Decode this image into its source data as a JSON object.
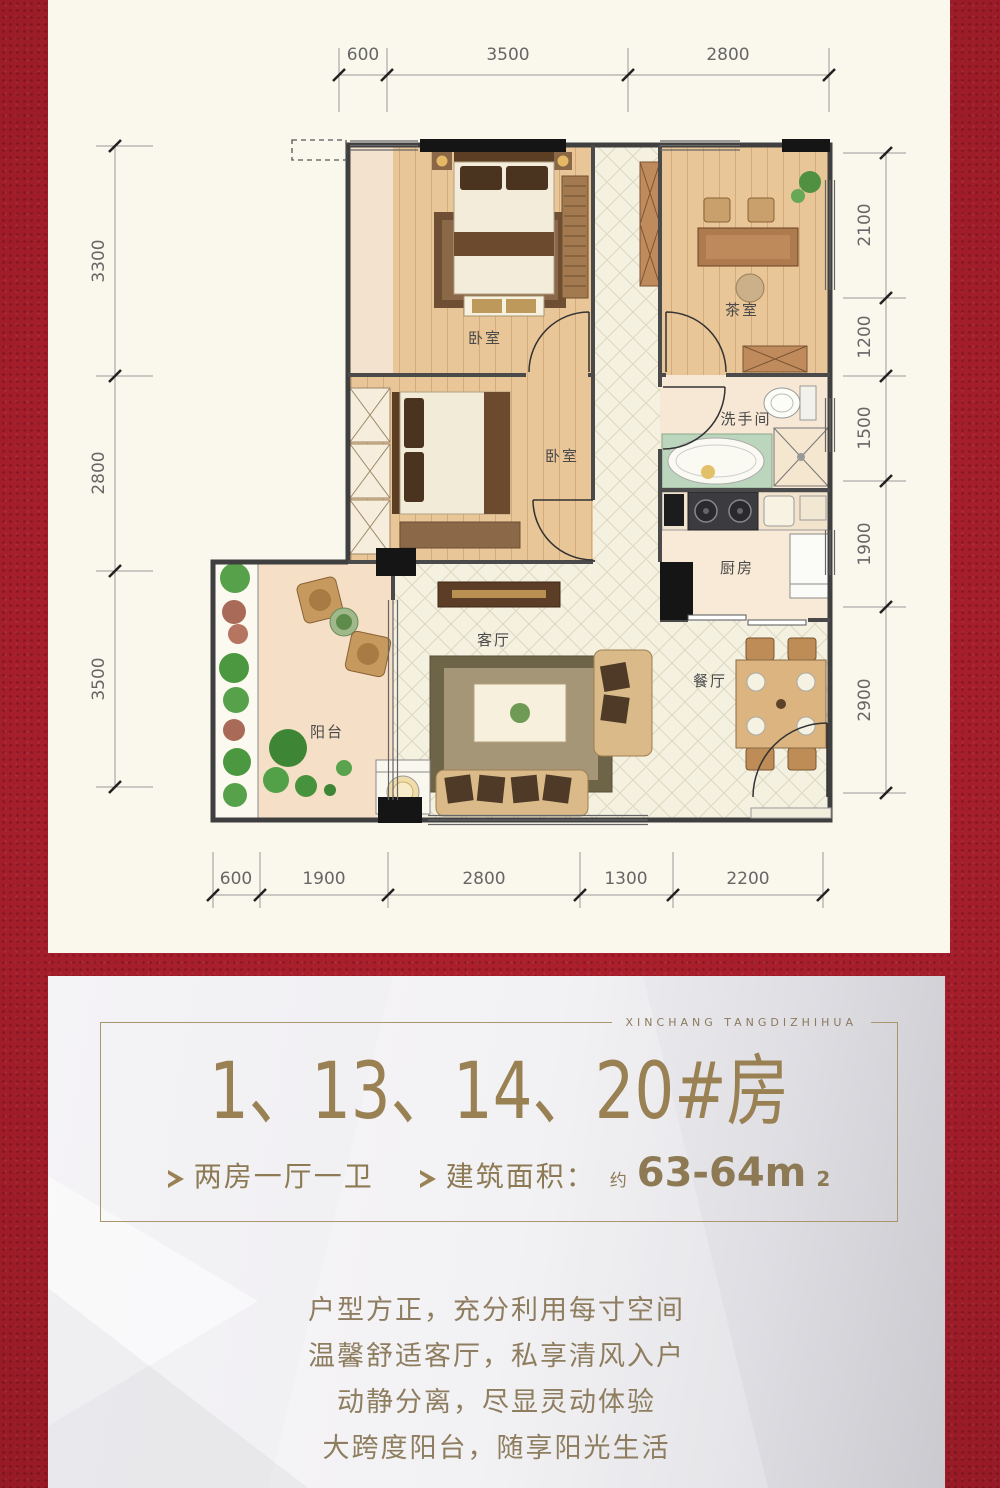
{
  "colors": {
    "background_red": "#AC1E2C",
    "panel_cream": "#FAF7EC",
    "gold": "#9A8154",
    "card_grey": "#E8E7EB",
    "wall": "#3F3F3F"
  },
  "plan": {
    "dims": {
      "top": [
        "600",
        "3500",
        "2800"
      ],
      "left": [
        "3300",
        "2800",
        "3500"
      ],
      "right": [
        "2100",
        "1200",
        "1500",
        "1900",
        "2900"
      ],
      "bottom": [
        "600",
        "1900",
        "2800",
        "1300",
        "2200"
      ]
    },
    "rooms": {
      "bedroom1": "卧室",
      "tearoom": "茶室",
      "bedroom2": "卧室",
      "washroom": "洗手间",
      "kitchen": "厨房",
      "living": "客厅",
      "dining": "餐厅",
      "balcony": "阳台"
    }
  },
  "card": {
    "brand": "XINCHANG TANGDIZHIHUA",
    "title": "1、13、14、20#房",
    "features": {
      "layout": "两房一厅一卫",
      "area_label": "建筑面积：",
      "area_approx": "约",
      "area_value": "63-64m",
      "area_sup": "2"
    },
    "paragraph": [
      "户型方正，充分利用每寸空间",
      "温馨舒适客厅，私享清风入户",
      "动静分离，尽显灵动体验",
      "大跨度阳台，随享阳光生活"
    ]
  }
}
